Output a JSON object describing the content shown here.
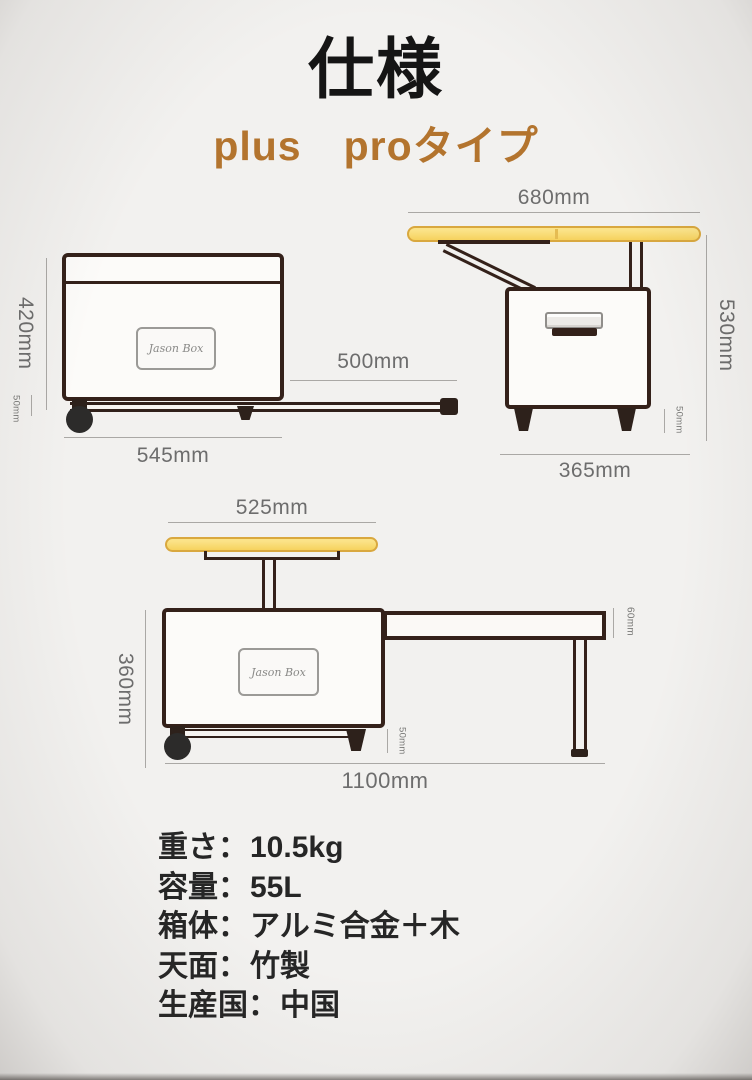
{
  "page": {
    "title": "仕様",
    "subtitle": "plus　proタイプ"
  },
  "brand": {
    "label": "Jason Box"
  },
  "colors": {
    "accent": "#b3742e",
    "line_art": "#34211a",
    "tabletop_fill": "#f6d25e",
    "tabletop_border": "#d9a83f",
    "dim_text": "#6d6d6d"
  },
  "diagram_closed": {
    "height": "420mm",
    "rail_height": "50mm",
    "base_width": "545mm",
    "slide_length": "500mm"
  },
  "diagram_open": {
    "top_width": "680mm",
    "height": "530mm",
    "foot_height": "50mm",
    "base_width": "365mm"
  },
  "diagram_extended": {
    "top_width": "525mm",
    "height": "360mm",
    "top_thickness": "60mm",
    "rail_height": "50mm",
    "total_width": "1100mm"
  },
  "specs": {
    "colon": "：",
    "rows": [
      {
        "label": "重さ",
        "value": "10.5kg"
      },
      {
        "label": "容量",
        "value": "55L"
      },
      {
        "label": "箱体",
        "value": "アルミ合金＋木"
      },
      {
        "label": "天面",
        "value": "竹製"
      },
      {
        "label": "生産国",
        "value": "中国"
      }
    ]
  }
}
